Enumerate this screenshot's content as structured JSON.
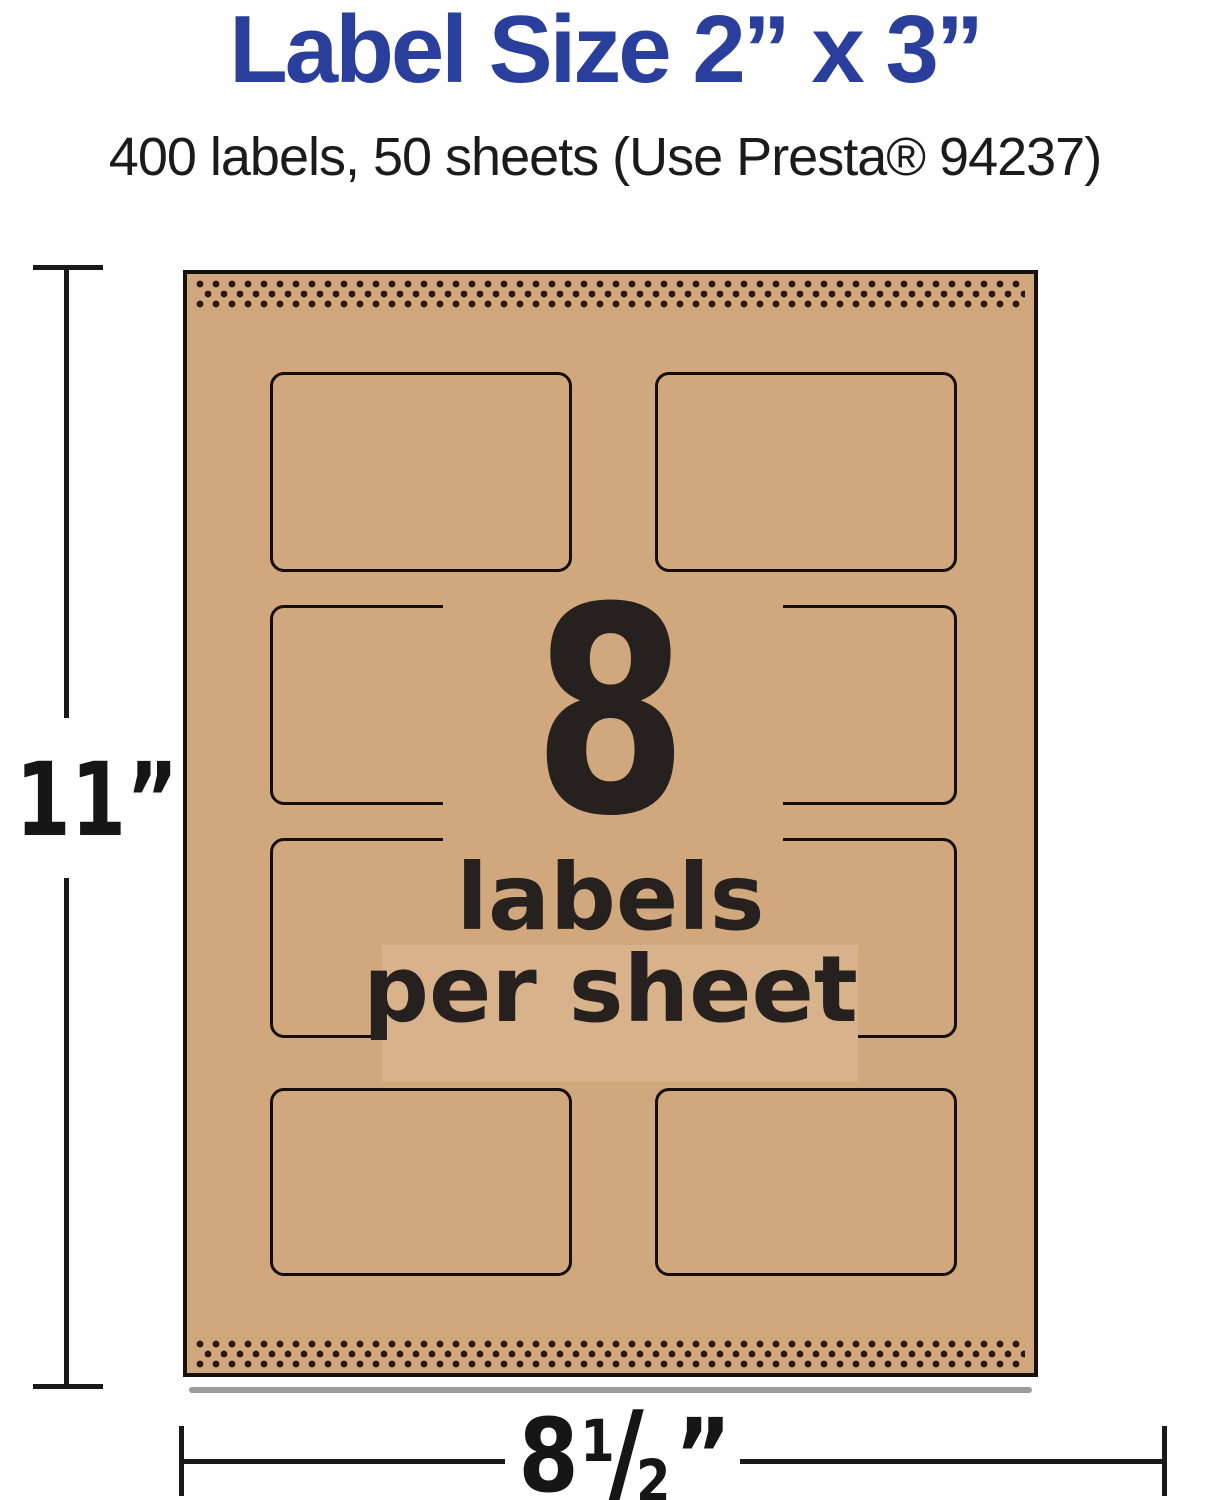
{
  "header": {
    "title": "Label Size 2” x 3”",
    "subtitle": "400 labels, 50 sheets (Use Presta® 94237)"
  },
  "sheet": {
    "labels_per_sheet_count": "8",
    "labels_word": "labels",
    "per_sheet_word": "per sheet",
    "grid": {
      "rows": 4,
      "cols": 2
    }
  },
  "dimensions": {
    "height_label": "11”",
    "width": {
      "whole": "8",
      "numerator": "1",
      "slash": "/",
      "denominator": "2",
      "quote": "”"
    }
  },
  "colors": {
    "title_blue": "#2a3e9b",
    "ink": "#231f20",
    "kraft": "#d1a87d",
    "kraft_light": "#d8b28a",
    "label_outline": "#150e07",
    "perforation_dot": "#2b190d",
    "dimension_line": "#1a1a1a"
  }
}
